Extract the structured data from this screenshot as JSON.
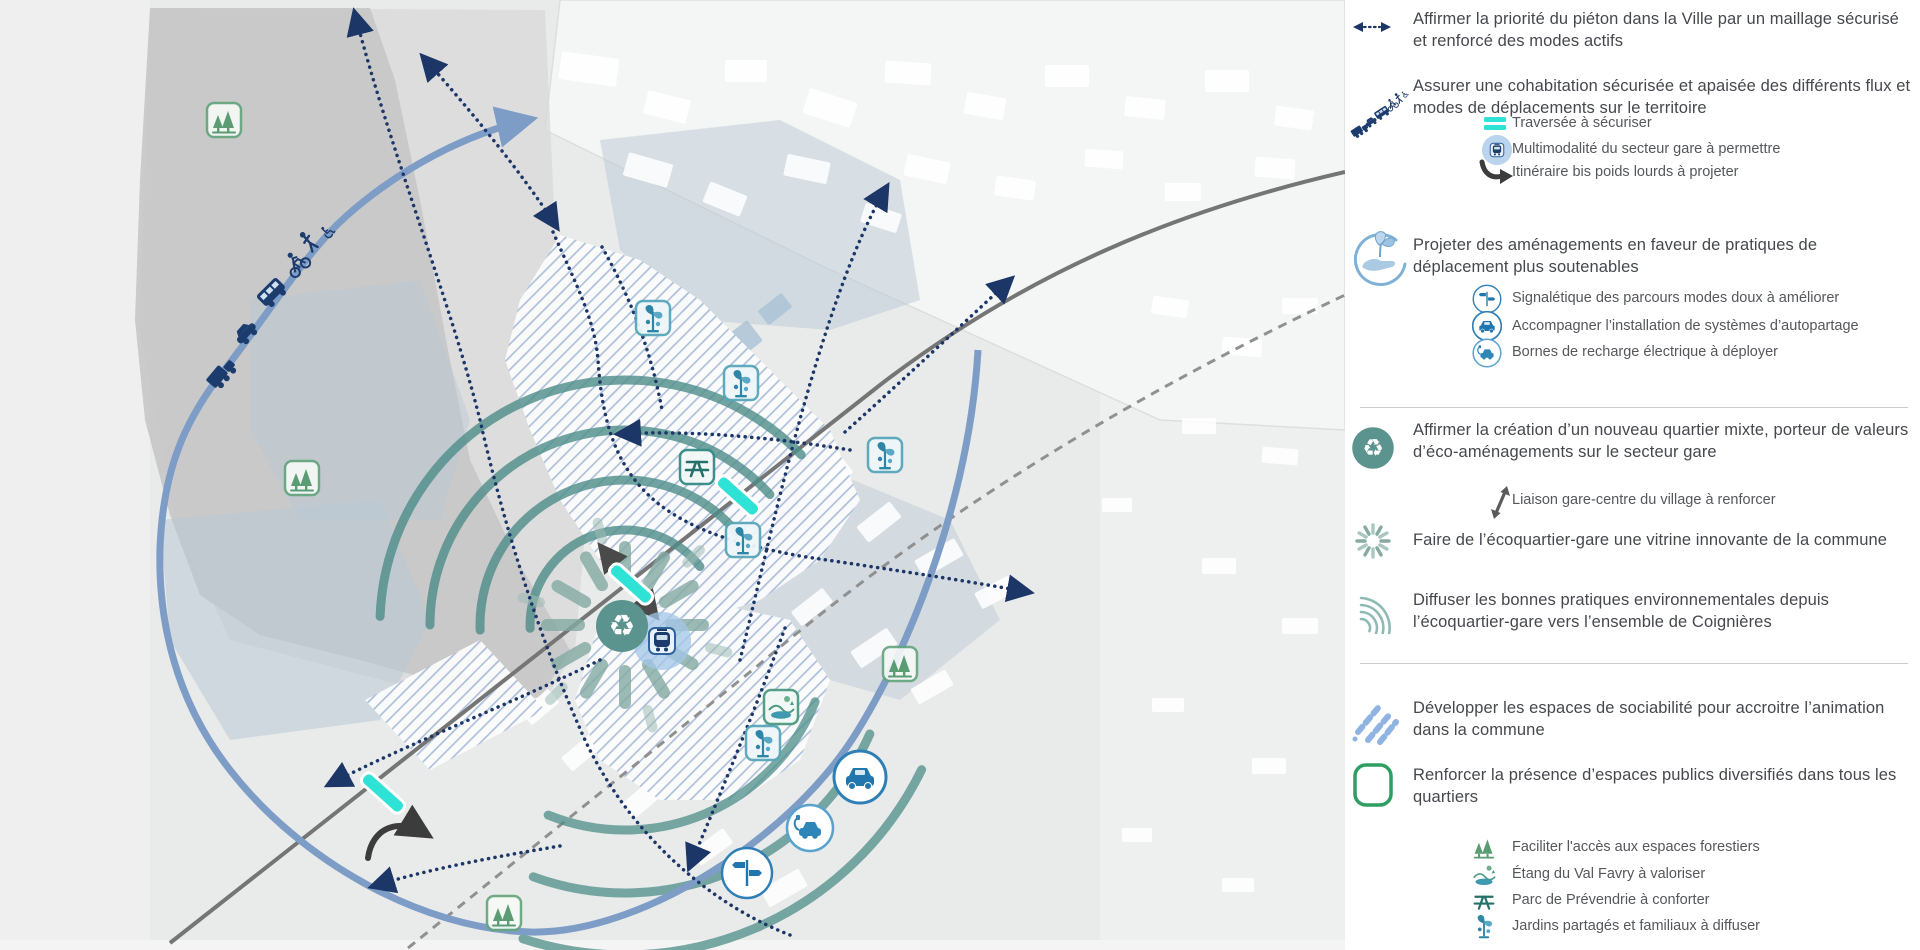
{
  "page": {
    "type": "urban-mobility-scheme-map",
    "language": "fr"
  },
  "colors": {
    "navy_dotted": "#1c3667",
    "blue_arc": "#7d9dc7",
    "teal_arc": "#4e8d88",
    "eco_teal": "#5b948e",
    "cyan_marker": "#2ee3d6",
    "green_outline": "#2f9e62",
    "forest_green": "#5b9c74",
    "icon_blue": "#2176ad",
    "hatch_blue": "#a9bdd9",
    "legend_text": "#46484e",
    "map_background": "#e9eaea"
  },
  "map": {
    "markers": [
      {
        "name": "forest",
        "x": 224,
        "y": 120
      },
      {
        "name": "forest",
        "x": 302,
        "y": 478
      },
      {
        "name": "forest",
        "x": 900,
        "y": 664
      },
      {
        "name": "forest",
        "x": 504,
        "y": 913
      },
      {
        "name": "jardin",
        "x": 653,
        "y": 318
      },
      {
        "name": "jardin",
        "x": 741,
        "y": 383
      },
      {
        "name": "jardin",
        "x": 885,
        "y": 455
      },
      {
        "name": "jardin",
        "x": 743,
        "y": 540
      },
      {
        "name": "jardin",
        "x": 763,
        "y": 743
      },
      {
        "name": "picnic",
        "x": 697,
        "y": 467
      },
      {
        "name": "etang",
        "x": 781,
        "y": 707
      },
      {
        "name": "carshare",
        "x": 860,
        "y": 777
      },
      {
        "name": "evcharge",
        "x": 810,
        "y": 828
      },
      {
        "name": "signpost",
        "x": 747,
        "y": 873
      },
      {
        "name": "train",
        "x": 662,
        "y": 641
      },
      {
        "name": "eco",
        "x": 622,
        "y": 626
      }
    ],
    "flux_icons": [
      {
        "name": "truck",
        "x": 222,
        "y": 373,
        "rot": -50
      },
      {
        "name": "car",
        "x": 246,
        "y": 333,
        "rot": -48
      },
      {
        "name": "bus",
        "x": 272,
        "y": 293,
        "rot": -45
      },
      {
        "name": "bike",
        "x": 297,
        "y": 264,
        "rot": -43
      },
      {
        "name": "ped",
        "x": 310,
        "y": 243,
        "rot": -42
      },
      {
        "name": "wheelchair",
        "x": 328,
        "y": 231,
        "rot": -40
      }
    ],
    "traversee_markers": [
      {
        "x": 738,
        "y": 496,
        "rot": 42
      },
      {
        "x": 631,
        "y": 584,
        "rot": 42
      },
      {
        "x": 383,
        "y": 793,
        "rot": 42
      }
    ]
  },
  "legend": {
    "items": [
      {
        "icon": "double-dotted-arrow",
        "level": "main",
        "label": "Affirmer la priorité du piéton dans la Ville par un maillage sécurisé et renforcé des modes actifs"
      },
      {
        "icon": "traffic-flux",
        "level": "main",
        "label": "Assurer une cohabitation sécurisée et apaisée des différents flux et modes de déplacements sur le territoire"
      },
      {
        "icon": "cyan-bars",
        "level": "sub",
        "label": "Traversée à sécuriser"
      },
      {
        "icon": "train-badge",
        "level": "sub",
        "label": "Multimodalité du secteur gare à permettre"
      },
      {
        "icon": "curved-black-arrow",
        "level": "sub",
        "label": "Itinéraire bis poids lourds à projeter"
      },
      {
        "icon": "hand-leaves",
        "level": "main",
        "label": "Projeter des aménagements en faveur de pratiques de déplacement plus soutenables"
      },
      {
        "icon": "signpost",
        "level": "sub",
        "label": "Signalétique des parcours modes doux à améliorer"
      },
      {
        "icon": "carshare",
        "level": "sub",
        "label": "Accompagner l’installation de systèmes d’autopartage"
      },
      {
        "icon": "evcharge",
        "level": "sub",
        "label": "Bornes de recharge électrique à déployer"
      },
      {
        "icon": "eco-circle",
        "level": "main",
        "label": "Affirmer la création d’un nouveau quartier mixte, porteur de valeurs d’éco-aménagements sur le secteur gare"
      },
      {
        "icon": "liaison-arrow",
        "level": "sub",
        "label": "Liaison gare-centre du village à renforcer"
      },
      {
        "icon": "sunburst",
        "level": "main",
        "label": "Faire de l’écoquartier-gare une vitrine innovante de la commune"
      },
      {
        "icon": "waves",
        "level": "main",
        "label": "Diffuser les bonnes pratiques environnementales depuis l’écoquartier-gare vers l’ensemble de Coignières"
      },
      {
        "icon": "blue-hatch",
        "level": "main",
        "label": "Développer les espaces de sociabilité pour accroitre l’animation dans la commune"
      },
      {
        "icon": "green-square",
        "level": "main",
        "label": "Renforcer la présence d’espaces publics diversifiés dans tous les quartiers"
      },
      {
        "icon": "forest",
        "level": "sub",
        "label": "Faciliter l'accès aux espaces forestiers"
      },
      {
        "icon": "etang",
        "level": "sub",
        "label": "Étang du Val Favry à valoriser"
      },
      {
        "icon": "picnic",
        "level": "sub",
        "label": "Parc de Prévendrie à conforter"
      },
      {
        "icon": "jardin",
        "level": "sub",
        "label": "Jardins partagés et familiaux à diffuser"
      }
    ]
  }
}
